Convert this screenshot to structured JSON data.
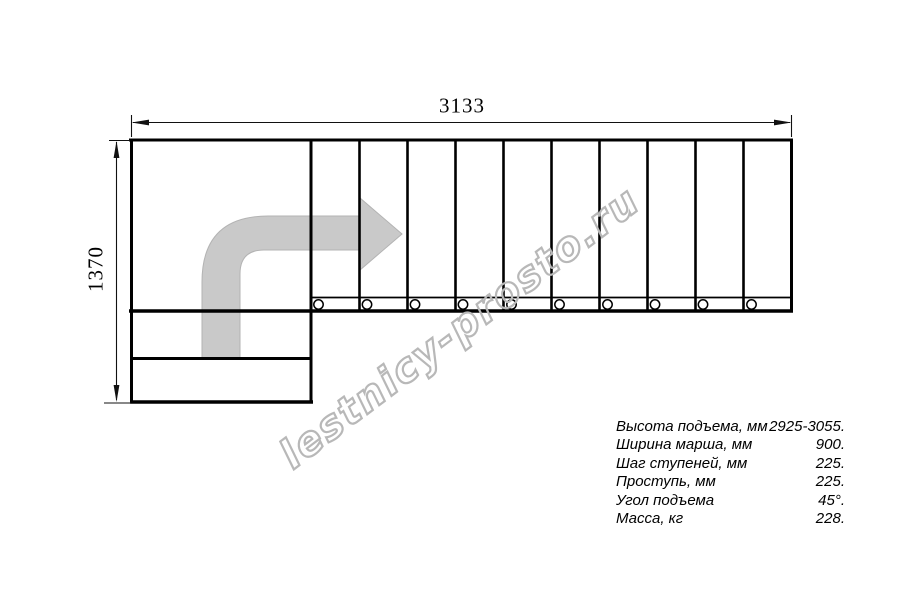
{
  "dimensions": {
    "width_label": "3133",
    "height_label": "1370"
  },
  "watermark": {
    "text": "lestnicy-prosto.ru"
  },
  "plan": {
    "tread_count": 10,
    "direction_arrow": "up-then-right"
  },
  "specs": {
    "rows": [
      {
        "label": "Высота подъема, мм",
        "value": "2925-3055."
      },
      {
        "label": "Ширина марша, мм",
        "value": "900."
      },
      {
        "label": "Шаг ступеней, мм",
        "value": "225."
      },
      {
        "label": "Проступь, мм",
        "value": "225."
      },
      {
        "label": "Угол подъема",
        "value": "45°."
      },
      {
        "label": "Масса, кг",
        "value": "228."
      }
    ]
  },
  "colors": {
    "background": "#ffffff",
    "line": "#000000",
    "arrow_fill": "#c9c9c9",
    "watermark": "#b8b8b8"
  }
}
